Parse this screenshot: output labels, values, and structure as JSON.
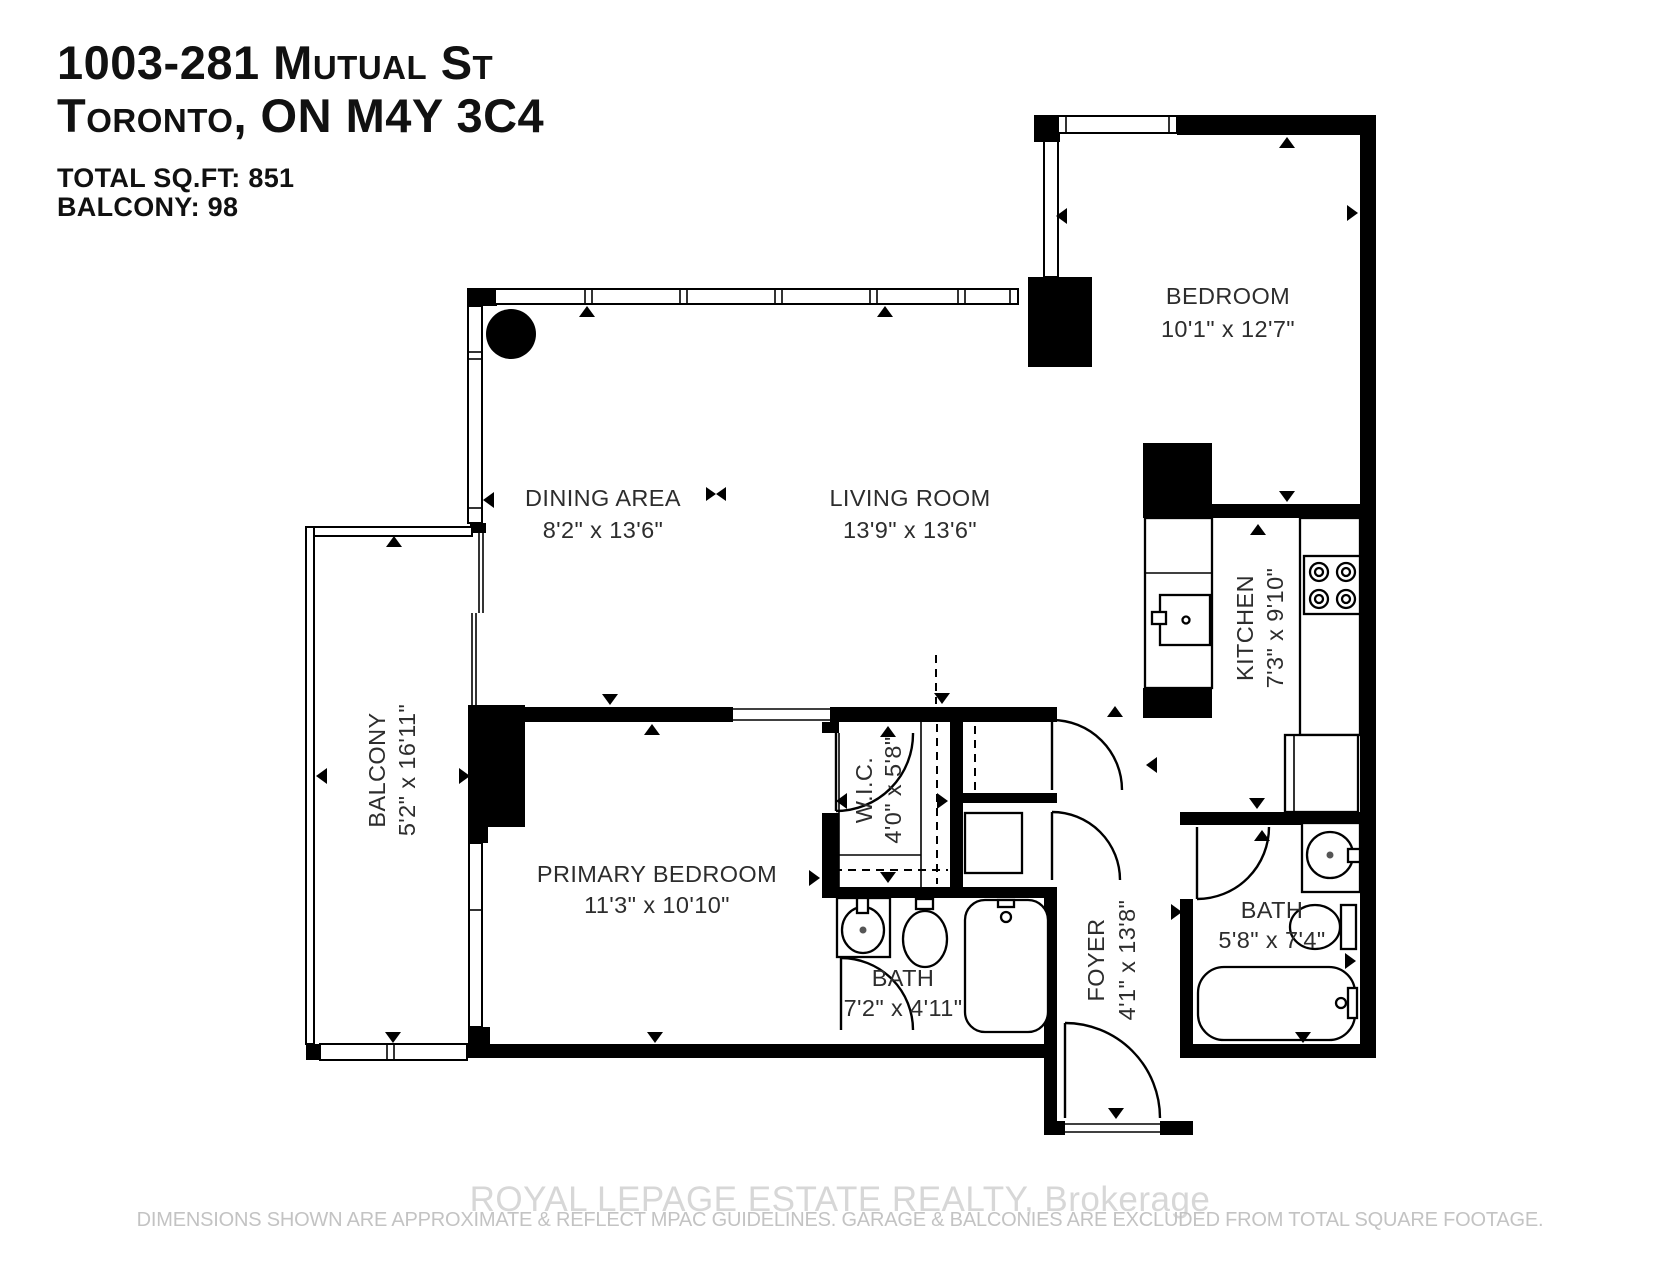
{
  "header": {
    "address_line1": "1003-281 Mutual St",
    "address_line2": "Toronto, ON M4Y 3C4",
    "total_sqft": "TOTAL SQ.FT: 851",
    "balcony_sqft": "BALCONY: 98"
  },
  "rooms": {
    "bedroom": {
      "name": "BEDROOM",
      "dims": "10'1\" x 12'7\""
    },
    "dining": {
      "name": "DINING AREA",
      "dims": "8'2\" x 13'6\""
    },
    "living": {
      "name": "LIVING ROOM",
      "dims": "13'9\" x 13'6\""
    },
    "kitchen": {
      "name": "KITCHEN",
      "dims": "7'3\" x 9'10\""
    },
    "balcony": {
      "name": "BALCONY",
      "dims": "5'2\" x 16'11\""
    },
    "primary": {
      "name": "PRIMARY BEDROOM",
      "dims": "11'3\" x 10'10\""
    },
    "wic": {
      "name": "W.I.C.",
      "dims": "4'0\" x 5'8\""
    },
    "bath1": {
      "name": "BATH",
      "dims": "7'2\" x 4'11\""
    },
    "foyer": {
      "name": "FOYER",
      "dims": "4'1\" x 13'8\""
    },
    "bath2": {
      "name": "BATH",
      "dims": "5'8\" x 7'4\""
    }
  },
  "footer": {
    "watermark": "ROYAL LEPAGE ESTATE REALTY, Brokerage",
    "disclaimer": "DIMENSIONS SHOWN ARE APPROXIMATE & REFLECT MPAC GUIDELINES. GARAGE & BALCONIES ARE EXCLUDED FROM TOTAL SQUARE FOOTAGE."
  },
  "colors": {
    "wall": "#000000",
    "watermark": "#d7d7d7",
    "disclaimer": "#c3c3c3"
  }
}
